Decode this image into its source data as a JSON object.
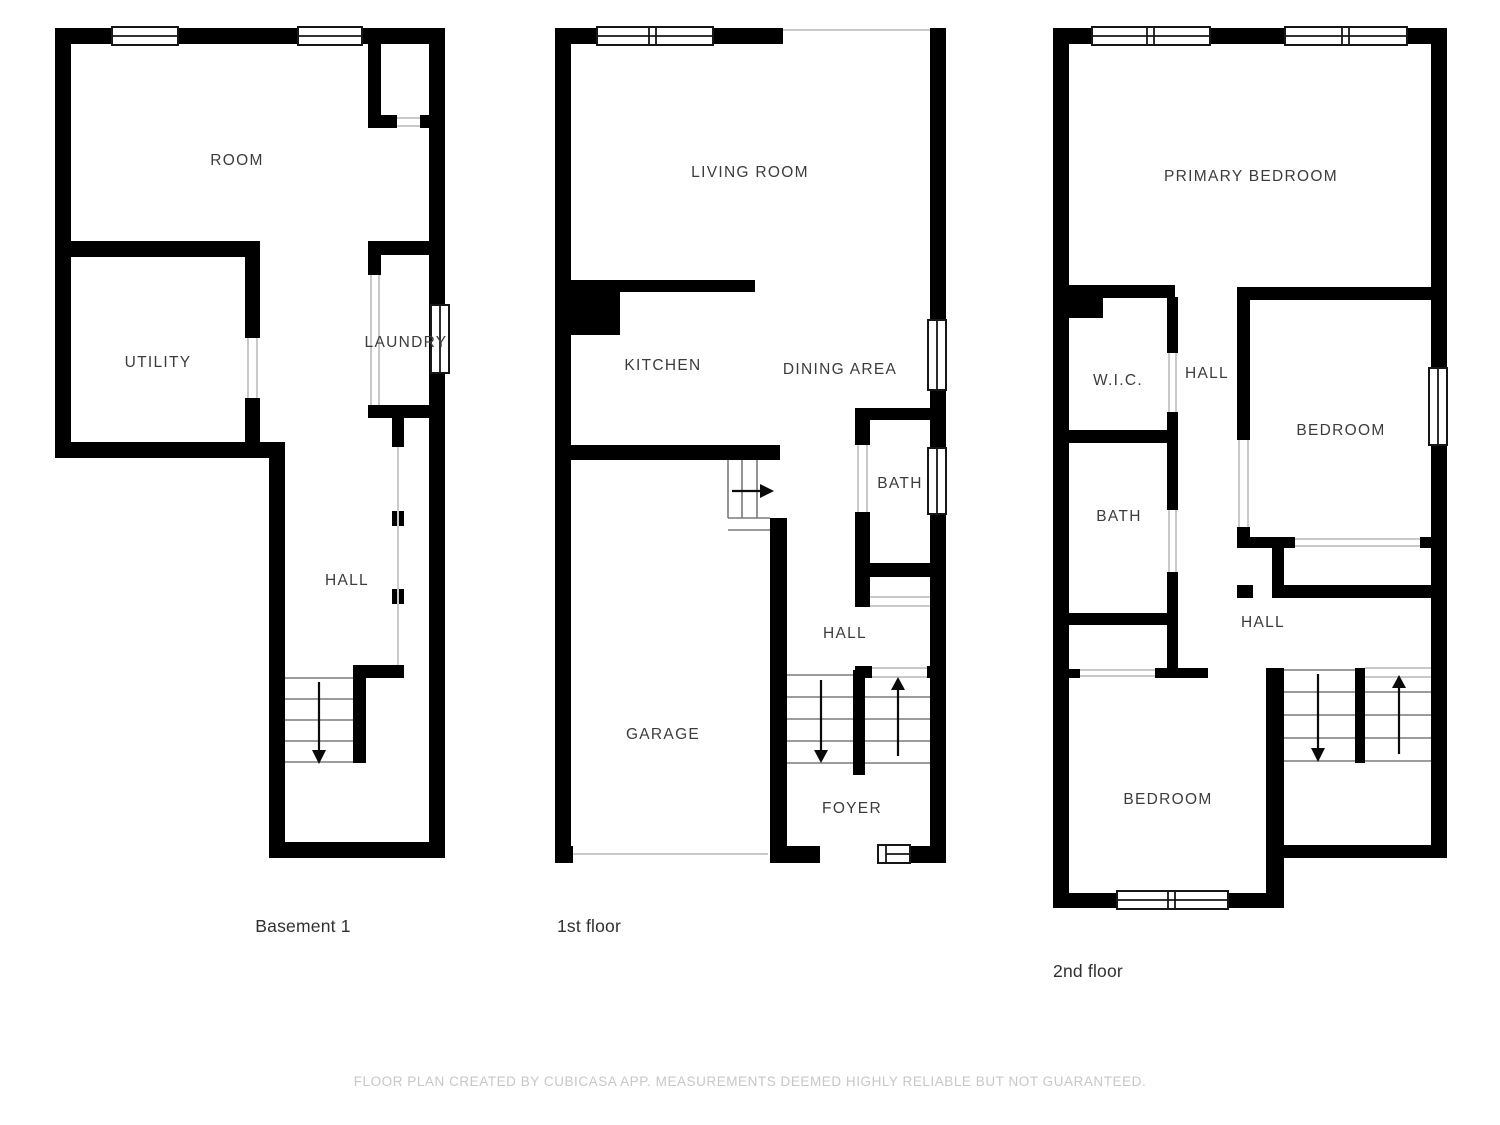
{
  "page": {
    "background": "#ffffff"
  },
  "colors": {
    "wall": "#000000",
    "window_frame": "#161616",
    "opening_line": "#c9c9c9",
    "stair_line": "#7a7a7a",
    "room_label": "#3c3c3c",
    "floor_label": "#303030",
    "footer_text": "#c7c7c7"
  },
  "floors": [
    {
      "name": "Basement 1",
      "rooms": [
        {
          "label": "ROOM"
        },
        {
          "label": "UTILITY"
        },
        {
          "label": "LAUNDRY"
        },
        {
          "label": "HALL"
        }
      ]
    },
    {
      "name": "1st floor",
      "rooms": [
        {
          "label": "LIVING ROOM"
        },
        {
          "label": "KITCHEN"
        },
        {
          "label": "DINING AREA"
        },
        {
          "label": "BATH"
        },
        {
          "label": "HALL"
        },
        {
          "label": "GARAGE"
        },
        {
          "label": "FOYER"
        }
      ]
    },
    {
      "name": "2nd floor",
      "rooms": [
        {
          "label": "PRIMARY BEDROOM"
        },
        {
          "label": "W.I.C."
        },
        {
          "label": "HALL"
        },
        {
          "label": "BEDROOM"
        },
        {
          "label": "BATH"
        },
        {
          "label": "HALL"
        },
        {
          "label": "BEDROOM"
        }
      ]
    }
  ],
  "footer": {
    "text": "FLOOR PLAN CREATED BY CUBICASA APP. MEASUREMENTS DEEMED HIGHLY RELIABLE BUT NOT GUARANTEED."
  }
}
